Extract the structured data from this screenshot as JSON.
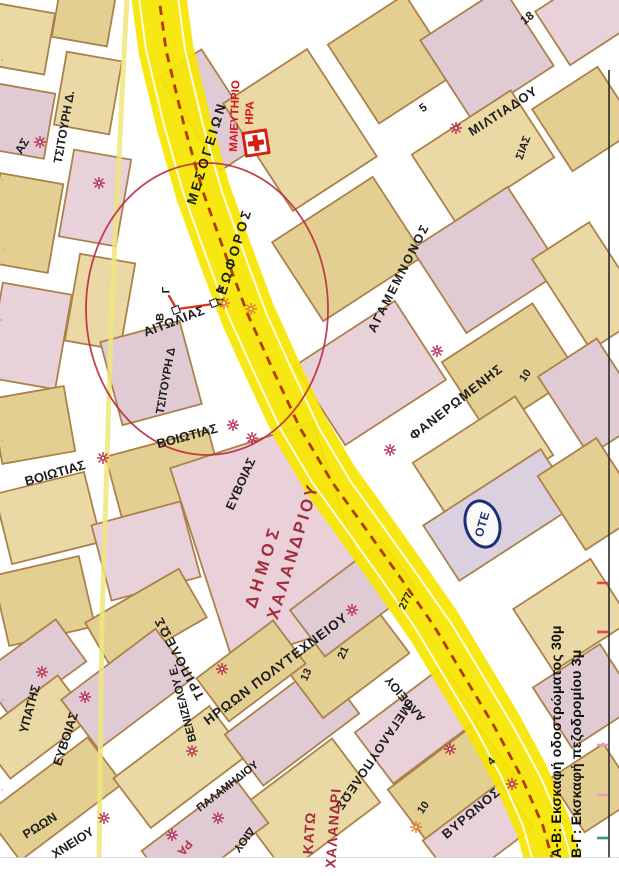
{
  "legend": {
    "line1": "Α-Β: Εκσκαφή οδοστρώματος 30μ",
    "line2": "Β-Γ: Εκσκαφή πεζοδρομίου 3μ"
  },
  "ote": {
    "text": "OTE"
  },
  "hospital": {
    "name": "ΜΑΙΕΥΤΗΡΙΟ ΗΡΑ",
    "icon": "red-cross"
  },
  "avenue_name": "ΛΕΩΦΟΡΟΣ ΜΕΣΟΓΕΙΩΝ",
  "municipality": "ΔΗΜΟΣ ΧΑΛΑΝΔΡΙΟΥ",
  "district": "ΚΑΤΩ ΧΑΛΑΝΔΡΙ",
  "excavation_points": [
    "Α",
    "Β",
    "Γ"
  ],
  "colors": {
    "avenue_yellow": "#f6e600",
    "avenue_dash_red": "#a82600",
    "circle_red": "#bb2c40",
    "label_black": "#1c1c1c",
    "municipality_red": "#a32d3d",
    "hospital_red": "#d41414",
    "asterisk_crimson": "#b5244a",
    "asterisk_orange": "#e0761c",
    "ote_navy": "#1d2f78",
    "block_border_brown": "#a87c42"
  },
  "labels": [
    {
      "id": "tsitouri-d-1",
      "text": "ΤΣΙΤΟΥΡΗ Δ.",
      "x": 64,
      "y": 127,
      "rot": -80,
      "fs": 12
    },
    {
      "id": "frag-as",
      "text": "ΑΣ",
      "x": 22,
      "y": 146,
      "rot": -60,
      "fs": 12
    },
    {
      "id": "maieytirio",
      "text": "ΜΑΙΕΥΤΗΡΙΟ",
      "x": 236,
      "y": 116,
      "rot": -88,
      "fs": 11.5,
      "color": "#d41414"
    },
    {
      "id": "ira",
      "text": "ΗΡΑ",
      "x": 251,
      "y": 113,
      "rot": -88,
      "fs": 11.5,
      "color": "#d41414"
    },
    {
      "id": "leoforos",
      "text": "ΛΕΩΦΟΡΟΣ",
      "x": 233,
      "y": 257,
      "rot": -73,
      "fs": 13.5,
      "ls": 3
    },
    {
      "id": "mesogeion",
      "text": "ΜΕΣΟΓΕΙΩΝ",
      "x": 207,
      "y": 153,
      "rot": -73,
      "fs": 13.5,
      "ls": 3
    },
    {
      "id": "miltiadou",
      "text": "ΜΙΛΤΙΑΔΟΥ",
      "x": 503,
      "y": 111,
      "rot": -33,
      "fs": 13,
      "ls": 1
    },
    {
      "id": "num-18",
      "text": "18",
      "x": 527,
      "y": 18,
      "rot": -38,
      "fs": 12
    },
    {
      "id": "num-5",
      "text": "5",
      "x": 424,
      "y": 109,
      "rot": -35,
      "fs": 11.5
    },
    {
      "id": "frag-sias",
      "text": "ΣΙΑΣ",
      "x": 524,
      "y": 148,
      "rot": -70,
      "fs": 11
    },
    {
      "id": "tsitouri-d-2",
      "text": "ΤΣΙΤΟΥΡΗ Δ",
      "x": 167,
      "y": 381,
      "rot": -80,
      "fs": 11.5
    },
    {
      "id": "aitolias",
      "text": "ΑΙΤΩΛΙΑΣ",
      "x": 174,
      "y": 321,
      "rot": -21,
      "fs": 13,
      "ls": 0.5
    },
    {
      "id": "agamemnonos",
      "text": "ΑΓΑΜΕΜΝΟΝΟΣ",
      "x": 399,
      "y": 278,
      "rot": -63,
      "fs": 12.5,
      "ls": 2
    },
    {
      "id": "faneromenis",
      "text": "ΦΑΝΕΡΩΜΕΝΗΣ",
      "x": 456,
      "y": 402,
      "rot": -38,
      "fs": 13,
      "ls": 1
    },
    {
      "id": "num-10a",
      "text": "10",
      "x": 526,
      "y": 376,
      "rot": -55,
      "fs": 11
    },
    {
      "id": "voiotias-1",
      "text": "ΒΟΙΩΤΙΑΣ",
      "x": 55,
      "y": 473,
      "rot": -16,
      "fs": 13
    },
    {
      "id": "voiotias-2",
      "text": "ΒΟΙΩΤΙΑΣ",
      "x": 187,
      "y": 436,
      "rot": -15,
      "fs": 13
    },
    {
      "id": "evvoias-1",
      "text": "ΕΥΒΟΙΑΣ",
      "x": 241,
      "y": 484,
      "rot": -66,
      "fs": 12.5
    },
    {
      "id": "dimos",
      "text": "ΔΗΜΟΣ",
      "x": 263,
      "y": 566,
      "rot": -73,
      "fs": 17,
      "color": "#a32d3d",
      "ls": 5
    },
    {
      "id": "xalandriou",
      "text": "ΧΑΛΑΝΔΡΙΟΥ",
      "x": 293,
      "y": 551,
      "rot": -73,
      "fs": 17,
      "color": "#a32d3d",
      "ls": 3
    },
    {
      "id": "ypatis",
      "text": "ΥΠΑΤΗΣ",
      "x": 30,
      "y": 709,
      "rot": -75,
      "fs": 12.5
    },
    {
      "id": "evvoias-2",
      "text": "ΕΥΒΟΙΑΣ",
      "x": 66,
      "y": 739,
      "rot": -72,
      "fs": 12.5
    },
    {
      "id": "tripoleos",
      "text": "ΤΡΙΠΟΛΕΩΣ",
      "x": 179,
      "y": 658,
      "rot": -118,
      "fs": 13,
      "ls": 2
    },
    {
      "id": "venizelou",
      "text": "ΒΕΝΙΖΕΛΟΥ Ε.",
      "x": 184,
      "y": 703,
      "rot": -105,
      "fs": 11.5
    },
    {
      "id": "iroon-polytexneiou",
      "text": "ΗΡΩΩΝ ΠΟΛΥΤΕΧΝΕΙΟΥ",
      "x": 276,
      "y": 669,
      "rot": -37,
      "fs": 13.5,
      "ls": 1
    },
    {
      "id": "num-277",
      "text": "277",
      "x": 406,
      "y": 601,
      "rot": -64,
      "fs": 10.5
    },
    {
      "id": "alfeiou",
      "text": "ΑΛΦΕΙΟΥ",
      "x": 405,
      "y": 699,
      "rot": -130,
      "fs": 12
    },
    {
      "id": "num-21",
      "text": "21",
      "x": 344,
      "y": 653,
      "rot": -66,
      "fs": 11
    },
    {
      "id": "num-13",
      "text": "13",
      "x": 307,
      "y": 675,
      "rot": -66,
      "fs": 11
    },
    {
      "id": "megaloupoleos",
      "text": "ΜΕΓΑΛΟΥΠΟΛΕΩΣ",
      "x": 373,
      "y": 757,
      "rot": 124,
      "fs": 12.5,
      "ls": 1
    },
    {
      "id": "num-10b",
      "text": "10",
      "x": 424,
      "y": 808,
      "rot": -55,
      "fs": 11
    },
    {
      "id": "kato",
      "text": "ΚΑΤΩ",
      "x": 309,
      "y": 833,
      "rot": -86,
      "fs": 14,
      "color": "#a32d3d",
      "ls": 1
    },
    {
      "id": "xalandri",
      "text": "ΧΑΛΑΝΔΡΙ",
      "x": 333,
      "y": 828,
      "rot": -86,
      "fs": 14,
      "color": "#a32d3d",
      "ls": 1
    },
    {
      "id": "palamidiou",
      "text": "ΠΑΛΑΜΗΔΙΟΥ",
      "x": 228,
      "y": 787,
      "rot": -38,
      "fs": 11
    },
    {
      "id": "frag-diou",
      "text": "ΔΙΟΥ",
      "x": 243,
      "y": 839,
      "rot": 127,
      "fs": 11.5
    },
    {
      "id": "frag-ra",
      "text": "ΡΑ",
      "x": 185,
      "y": 848,
      "rot": 130,
      "fs": 12,
      "color": "#b03545"
    },
    {
      "id": "vyronos",
      "text": "ΒΥΡΩΝΟΣ",
      "x": 471,
      "y": 813,
      "rot": -40,
      "fs": 13,
      "ls": 1
    },
    {
      "id": "num-4",
      "text": "4",
      "x": 492,
      "y": 762,
      "rot": -45,
      "fs": 11
    },
    {
      "id": "frag-roon",
      "text": "ΡΩΩΝ",
      "x": 40,
      "y": 826,
      "rot": -32,
      "fs": 12.5
    },
    {
      "id": "frag-xneiou",
      "text": "ΧΝΕΙΟΥ",
      "x": 73,
      "y": 843,
      "rot": -32,
      "fs": 12.5
    },
    {
      "id": "marker-g",
      "text": "Γ",
      "x": 167,
      "y": 290,
      "rot": -90,
      "fs": 11
    },
    {
      "id": "marker-b",
      "text": "Β",
      "x": 161,
      "y": 317,
      "rot": -90,
      "fs": 11
    },
    {
      "id": "marker-a",
      "text": "Α",
      "x": 221,
      "y": 290,
      "rot": -90,
      "fs": 11
    }
  ],
  "asterisks": [
    {
      "x": 40,
      "y": 141,
      "c": "crimson"
    },
    {
      "x": 99,
      "y": 182,
      "c": "crimson"
    },
    {
      "x": 456,
      "y": 127,
      "c": "crimson"
    },
    {
      "x": 224,
      "y": 302,
      "c": "orange"
    },
    {
      "x": 251,
      "y": 308,
      "c": "orange"
    },
    {
      "x": 437,
      "y": 350,
      "c": "crimson"
    },
    {
      "x": 390,
      "y": 449,
      "c": "crimson"
    },
    {
      "x": 103,
      "y": 457,
      "c": "crimson"
    },
    {
      "x": 233,
      "y": 424,
      "c": "crimson"
    },
    {
      "x": 252,
      "y": 437,
      "c": "crimson"
    },
    {
      "x": 42,
      "y": 671,
      "c": "crimson"
    },
    {
      "x": 85,
      "y": 696,
      "c": "crimson"
    },
    {
      "x": 192,
      "y": 750,
      "c": "crimson"
    },
    {
      "x": 222,
      "y": 668,
      "c": "crimson"
    },
    {
      "x": 352,
      "y": 609,
      "c": "crimson"
    },
    {
      "x": 104,
      "y": 817,
      "c": "crimson"
    },
    {
      "x": 218,
      "y": 817,
      "c": "crimson"
    },
    {
      "x": 172,
      "y": 834,
      "c": "crimson"
    },
    {
      "x": 416,
      "y": 826,
      "c": "orange"
    },
    {
      "x": 512,
      "y": 783,
      "c": "crimson"
    },
    {
      "x": 450,
      "y": 748,
      "c": "crimson"
    }
  ],
  "marker_squares": [
    {
      "x": 176,
      "y": 310
    },
    {
      "x": 214,
      "y": 303
    }
  ]
}
